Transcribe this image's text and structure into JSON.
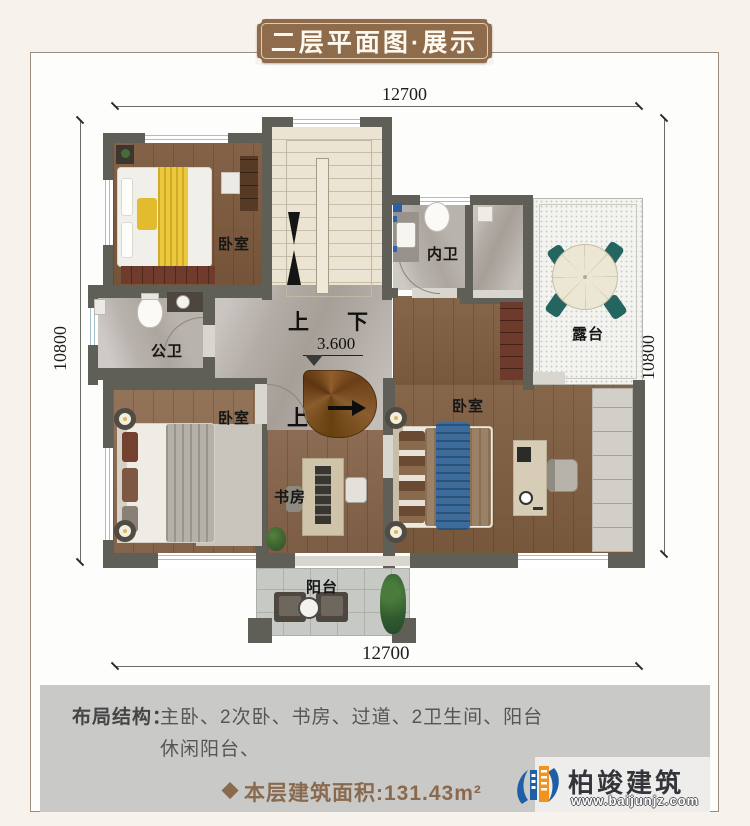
{
  "title": "二层平面图·展示",
  "dimensions": {
    "top": "12700",
    "bottom": "12700",
    "left": "10800",
    "right": "10800"
  },
  "plan": {
    "labels": {
      "bedroom_tl": "卧室",
      "bedroom_bl": "卧室",
      "bedroom_r": "卧室",
      "inner_bath": "内卫",
      "public_bath": "公卫",
      "terrace": "露台",
      "study": "书房",
      "balcony": "阳台",
      "up": "上",
      "down": "下",
      "up2": "上",
      "elevation": "3.600"
    }
  },
  "footer": {
    "layout_label": "布局结构：",
    "layout_line1": "主卧、2次卧、书房、过道、2卫生间、阳台",
    "layout_line2": "休闲阳台、",
    "area_diamond": "◆",
    "area_text": "本层建筑面积:131.43m²"
  },
  "logo": {
    "name": "柏竣建筑",
    "url": "www.baijunjz.com"
  },
  "colors": {
    "badge_brown": "#8d6b4b",
    "wall": "#5f5f57",
    "area_text_brown": "#8a6a4e",
    "logo_blue": "#1f5fa8",
    "logo_orange": "#f0941f",
    "panel_gray": "#c9c9c7",
    "background": "#f7f2ec"
  }
}
